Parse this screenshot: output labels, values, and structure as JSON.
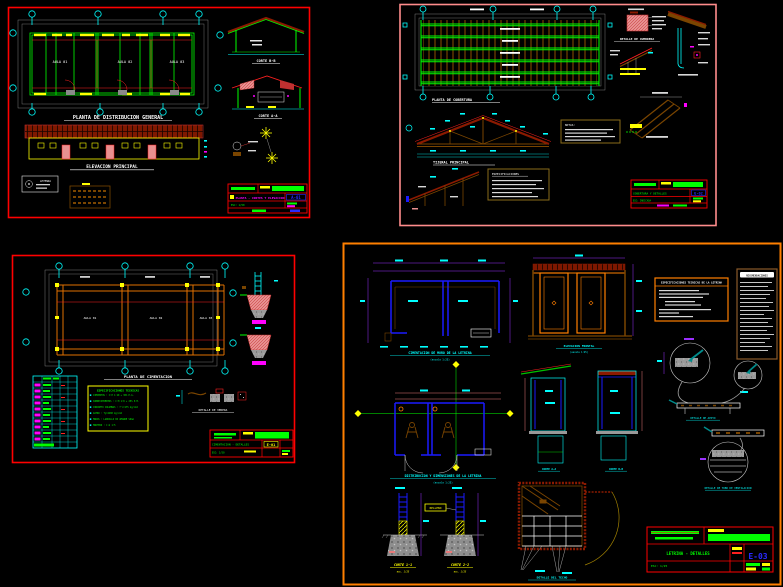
{
  "colors": {
    "background": "#000000",
    "sheet_border_red": "#ff0000",
    "sheet_border_pink": "#ff8c8c",
    "sheet_border_orange": "#ff7f00",
    "line_green": "#00ff00",
    "line_cyan": "#00ffff",
    "line_yellow": "#ffff00",
    "line_magenta": "#ff00ff",
    "line_blue": "#1a1aff",
    "wood_brown": "#7a4500",
    "roof_dark_red": "#8b1a00",
    "hatch_pink": "#e89090",
    "dim_purple": "#9b30ff",
    "arrow_teal": "#008b8b",
    "detail_gray": "#9e9e9e"
  },
  "sheet_a01": {
    "plan_title": "PLANTA DE DISTRIBUCION GENERAL",
    "rooms": [
      "AULA 01",
      "AULA 02",
      "AULA 03"
    ],
    "elevation_title": "ELEVACION PRINCIPAL",
    "corte_b_title": "CORTE B-B",
    "corte_a_title": "CORTE A-A",
    "legend_title": "LEYENDA",
    "titleblock": {
      "plano": "PLANTA - CORTES Y ELEVACION",
      "sheet_no": "A-01",
      "escala": "ESC: 1/50"
    }
  },
  "sheet_e02": {
    "plan_title": "PLANTA DE COBERTURA",
    "truss_title": "TIJERAL PRINCIPAL",
    "cumbrera_title": "DETALLE DE CUMBRERA",
    "notes_title": "ESPECIFICACIONES",
    "notes2_title": "NOTAS:",
    "titleblock": {
      "plano": "COBERTURA Y DETALLES",
      "sheet_no": "E-02",
      "escala": "ESC: INDICADA"
    }
  },
  "sheet_e01": {
    "plan_title": "PLANTA DE CIMENTACION",
    "rooms": [
      "AULA 01",
      "AULA 02",
      "AULA 03"
    ],
    "specs_title": "ESPECIFICACIONES TECNICAS",
    "specs_lines": [
      "CIMIENTOS : C:H 1:10 + 30% P.G.",
      "SOBRECIMIENTOS : C:H 1:8 + 25% P.M.",
      "CONCRETO COLUMNAS : f'c=175 kg/cm2",
      "ACERO : fy=4200 kg/cm2",
      "MUROS : LADRILLO KK AMARRE SOGA",
      "MORTERO : C:A 1:5"
    ],
    "vereda_label": "DETALLE DE VEREDA",
    "titleblock": {
      "plano": "CIMENTACION - DETALLES",
      "sheet_no": "E-01",
      "escala": "ESC: 1/50"
    }
  },
  "sheet_e03": {
    "cimentacion_title": "CIMENTACION DE MURO DE LA LETRINA",
    "cimentacion_scale": "(escala 1:25)",
    "distribucion_title": "DISTRIBUCION Y DIMENSIONES DE LA LETRINA",
    "distribucion_scale": "(escala 1:25)",
    "elevacion_title": "ELEVACION FRONTAL",
    "elevacion_scale": "(escala 1:25)",
    "corte1_title": "CORTE 1-1",
    "corte1_scale": "esc. 1/25",
    "corte2_title": "CORTE 2-2",
    "corte2_scale": "esc. 1/25",
    "relleno_label": "RELLENO",
    "seccion1_label": "CORTE A-A",
    "seccion2_label": "CORTE B-B",
    "techo_title": "DETALLE DEL TECHO",
    "orange_notes_title": "ESPECIFICACIONES TECNICAS DE LA LETRINA",
    "brown_notes_title": "RECOMENDACIONES",
    "apoyo_label": "DETALLE DE APOYO",
    "tubo_label": "DETALLE DE TUBO DE VENTILACION",
    "titleblock": {
      "plano": "LETRINA  -  DETALLES",
      "sheet_no": "E-03",
      "escala": "ESC: 1/25"
    }
  }
}
